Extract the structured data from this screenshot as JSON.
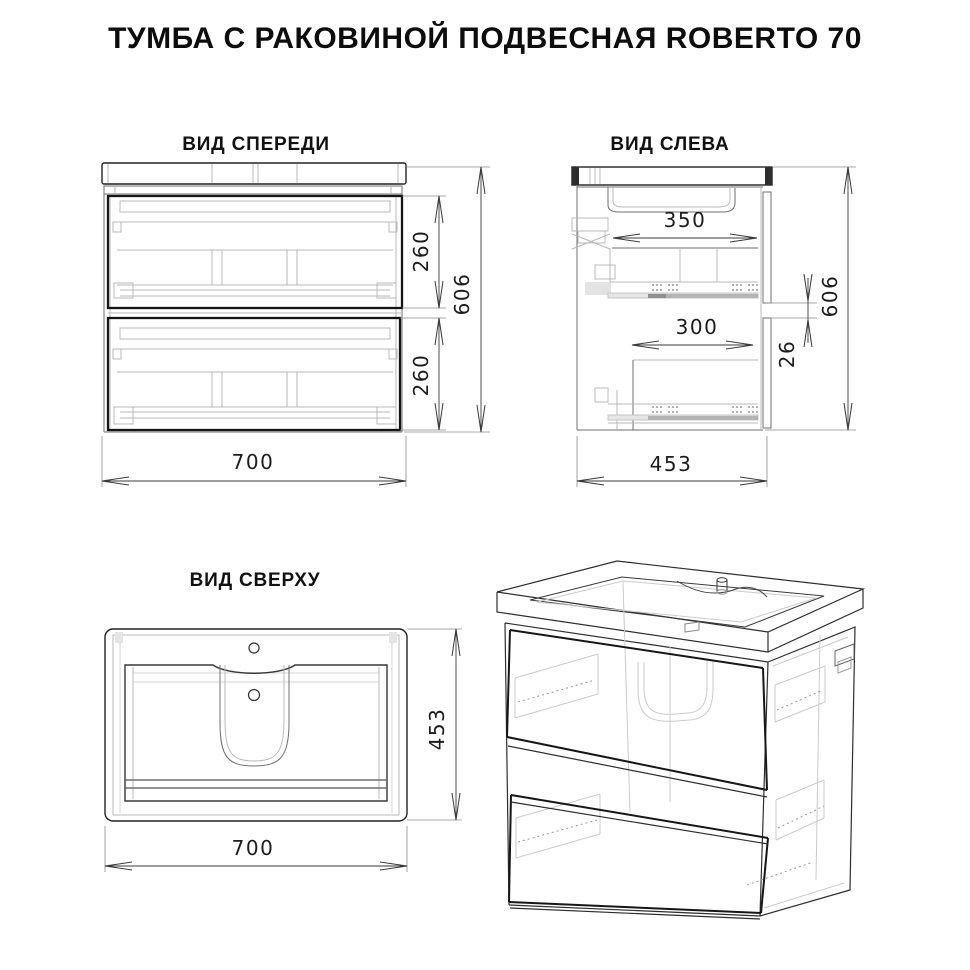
{
  "title": "ТУМБА С РАКОВИНОЙ ПОДВЕСНАЯ ROBERTO 70",
  "views": {
    "front": {
      "label": "ВИД СПЕРЕДИ",
      "dims": {
        "top_drawer_height": "260",
        "bottom_drawer_height": "260",
        "total_height": "606",
        "width": "700"
      }
    },
    "left": {
      "label": "ВИД СЛЕВА",
      "dims": {
        "top_drawer_depth": "350",
        "bottom_drawer_depth": "300",
        "mount_rail_gap": "26",
        "total_height": "606",
        "depth": "453"
      }
    },
    "top": {
      "label": "ВИД СВЕРХУ",
      "dims": {
        "depth": "453",
        "width": "700"
      }
    }
  }
}
